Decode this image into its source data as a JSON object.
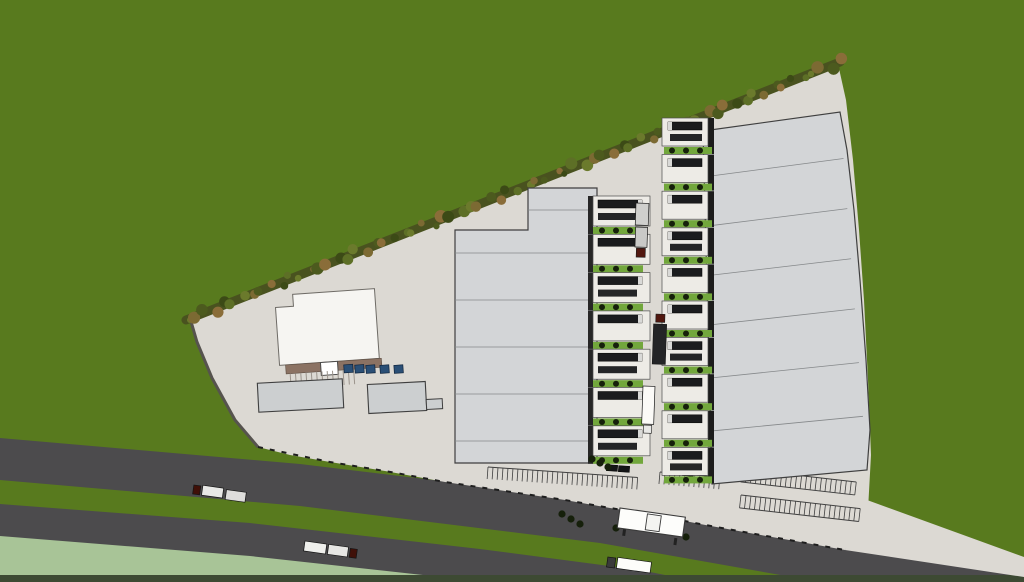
{
  "scene": {
    "label": "aerial-3d-render-logistics-park-site-plan",
    "canvas": {
      "width": 1024,
      "height": 582
    },
    "colors": {
      "grass": "#587a1e",
      "infield": "#a8c497",
      "road": "#4c4b4d",
      "pavement": "#dcd9d3",
      "apron": "#edebe6",
      "roof": "#d3d5d7",
      "roof_seam": "#85888a",
      "outline": "#3f3f3f",
      "office_white": "#f6f5f2",
      "canopy_brown": "#8b7263",
      "small_building": "#cccfd0",
      "dock_green": "#72a73c",
      "bush": "#16200b",
      "trailer_dark": "#1b1c1e",
      "trailer_cap": "#d9d9d7",
      "cab_red": "#51170f",
      "fence": "#1e1e1e",
      "wall_dark": "#56534e",
      "wall_light": "#e4e1da",
      "bottom_strip": "#3d4a33",
      "car_blue": "#2a4f76",
      "car_dark": "#141517",
      "tree_band": "#49521f",
      "tree_palette": [
        "#6b7a2c",
        "#7c6a33",
        "#4c5a1e",
        "#8a6d39",
        "#3c4a16",
        "#5d6f26"
      ]
    },
    "landscape": {
      "infield_polygon": [
        [
          0,
          534
        ],
        [
          250,
          553
        ],
        [
          430,
          570
        ],
        [
          555,
          582
        ],
        [
          0,
          582
        ]
      ],
      "road_upper_polygon": [
        [
          0,
          438
        ],
        [
          300,
          464
        ],
        [
          600,
          500
        ],
        [
          870,
          549
        ],
        [
          1024,
          575
        ],
        [
          1024,
          582
        ],
        [
          820,
          582
        ],
        [
          600,
          543
        ],
        [
          300,
          506
        ],
        [
          0,
          480
        ]
      ],
      "road_lower_polygon": [
        [
          0,
          504
        ],
        [
          250,
          523
        ],
        [
          480,
          549
        ],
        [
          640,
          570
        ],
        [
          700,
          582
        ],
        [
          485,
          582
        ],
        [
          450,
          578
        ],
        [
          250,
          556
        ],
        [
          0,
          536
        ]
      ],
      "bottom_strip_rect": [
        0,
        575,
        1024,
        7
      ]
    },
    "site": {
      "pavement_polygon": [
        [
          190,
          318
        ],
        [
          838,
          64
        ],
        [
          846,
          100
        ],
        [
          853,
          160
        ],
        [
          859,
          230
        ],
        [
          864,
          300
        ],
        [
          868,
          380
        ],
        [
          871,
          455
        ],
        [
          868,
          510
        ],
        [
          845,
          550
        ],
        [
          795,
          541
        ],
        [
          755,
          534
        ],
        [
          700,
          524
        ],
        [
          655,
          515
        ],
        [
          610,
          508
        ],
        [
          565,
          500
        ],
        [
          505,
          491
        ],
        [
          445,
          482
        ],
        [
          385,
          471
        ],
        [
          330,
          462
        ],
        [
          290,
          455
        ],
        [
          258,
          447
        ],
        [
          235,
          420
        ],
        [
          212,
          378
        ],
        [
          197,
          342
        ]
      ],
      "access_apron_polygon": [
        [
          867,
          500
        ],
        [
          1024,
          557
        ],
        [
          1024,
          577
        ],
        [
          845,
          550
        ]
      ],
      "top_wall_line": [
        190,
        318,
        838,
        64
      ],
      "left_wall_path": "M190,318 L197,342 L212,378 L235,420 L258,447",
      "fence_path": "M258,447 L330,462 L385,471 L445,482 L505,491 L565,500 L610,508 L655,515 L700,524 L755,534 L795,541 L845,550",
      "tree_line": {
        "from": [
          186,
          320
        ],
        "to": [
          840,
          62
        ],
        "count": 70
      }
    },
    "buildings": {
      "warehouse_left": {
        "polygon": [
          [
            528,
            188
          ],
          [
            597,
            188
          ],
          [
            597,
            463
          ],
          [
            455,
            463
          ],
          [
            455,
            230
          ],
          [
            528,
            230
          ]
        ],
        "seams": [
          {
            "x1": 528,
            "x2": 597,
            "y": 210
          },
          {
            "x1": 455,
            "x2": 597,
            "y": 253
          },
          {
            "x1": 455,
            "x2": 597,
            "y": 300
          },
          {
            "x1": 455,
            "x2": 597,
            "y": 347
          },
          {
            "x1": 455,
            "x2": 597,
            "y": 394
          },
          {
            "x1": 455,
            "x2": 597,
            "y": 441
          }
        ]
      },
      "warehouse_right": {
        "polygon": [
          [
            703,
            131
          ],
          [
            840,
            112
          ],
          [
            847,
            150
          ],
          [
            854,
            210
          ],
          [
            860,
            280
          ],
          [
            866,
            360
          ],
          [
            870,
            430
          ],
          [
            867,
            470
          ],
          [
            712,
            484
          ]
        ],
        "left_edge": {
          "top": [
            703,
            131
          ],
          "bottom": [
            712,
            484
          ]
        },
        "right_edge": {
          "top": [
            840,
            112
          ],
          "bottom": [
            867,
            470
          ]
        },
        "seam_ts": [
          0.13,
          0.27,
          0.41,
          0.55,
          0.7,
          0.85
        ]
      },
      "office": {
        "polygon": [
          [
            277,
            304
          ],
          [
            295,
            304
          ],
          [
            295,
            292
          ],
          [
            377,
            292
          ],
          [
            377,
            362
          ],
          [
            277,
            362
          ]
        ],
        "rotate": [
          -4,
          327,
          327
        ],
        "canopy": [
          283,
          362,
          96,
          9
        ],
        "canopy_box": [
          318,
          362,
          17,
          13
        ],
        "comb": {
          "x": 287,
          "y": 371,
          "count": 13,
          "step": 5.3,
          "len": 15
        },
        "cars_blue": [
          [
            341,
            366
          ],
          [
            352,
            367
          ],
          [
            363,
            368
          ],
          [
            377,
            369
          ],
          [
            391,
            370
          ]
        ]
      },
      "storage_a": {
        "rect": [
          258,
          381,
          85,
          29
        ],
        "rotate": [
          -3,
          300,
          395
        ]
      },
      "storage_b": {
        "rect": [
          368,
          383,
          58,
          29
        ],
        "tab": [
          426,
          401,
          16,
          10
        ],
        "rotate": [
          -3,
          397,
          397
        ]
      },
      "gatehouse": {
        "x": 620,
        "y": 508,
        "angle": 8,
        "body": [
          0,
          0,
          66,
          20
        ],
        "inner": [
          28,
          2,
          14,
          16
        ],
        "posts": [
          [
            6,
            20,
            3,
            7
          ],
          [
            58,
            22,
            3,
            7
          ]
        ]
      }
    },
    "docks": {
      "left_row": {
        "x": 593,
        "y_start": 196,
        "pitch": 38.3,
        "count": 7,
        "width": 57,
        "apron_h": 30,
        "facing": "east"
      },
      "right_row": {
        "x": 662,
        "y_start": 118,
        "pitch": 36.6,
        "count": 10,
        "width": 46,
        "apron_h": 28,
        "facing": "west"
      }
    },
    "parking": {
      "rows": [
        {
          "x": 488,
          "y": 467,
          "angle": 4,
          "count": 30,
          "stall": 5,
          "depth": 12,
          "double": false
        },
        {
          "x": 660,
          "y": 472,
          "angle": 5,
          "count": 12,
          "stall": 5,
          "depth": 12,
          "double": false
        },
        {
          "x": 742,
          "y": 469,
          "angle": 6.5,
          "count": 23,
          "stall": 5,
          "depth": 13,
          "double": true
        },
        {
          "x": 741,
          "y": 495,
          "angle": 6.5,
          "count": 24,
          "stall": 5,
          "depth": 13,
          "double": true
        }
      ],
      "cars": [
        [
          612,
          468,
          4
        ],
        [
          624,
          469,
          4
        ],
        [
          688,
          473,
          5
        ],
        [
          739,
          473,
          80
        ]
      ]
    },
    "bushes": [
      [
        562,
        514
      ],
      [
        571,
        519
      ],
      [
        580,
        524
      ],
      [
        616,
        528
      ],
      [
        686,
        537
      ],
      [
        592,
        459
      ],
      [
        600,
        463
      ],
      [
        608,
        467
      ]
    ],
    "vehicles": {
      "yard_trucks": [
        {
          "x": 636,
          "y": 203,
          "angle": 2,
          "boxes": [
            [
              0,
              0,
              13,
              22,
              "#cfcfcd"
            ],
            [
              0.5,
              24,
              12,
              20,
              "#c9c9c7"
            ]
          ],
          "cab": [
            2,
            45,
            9,
            9,
            "#51170f"
          ]
        },
        {
          "x": 654,
          "y": 314,
          "angle": 2,
          "boxes": [
            [
              0,
              10,
              13,
              40,
              "#232426"
            ]
          ],
          "cab": [
            2,
            0,
            9,
            8,
            "#51170f"
          ]
        },
        {
          "x": 643,
          "y": 386,
          "angle": 2,
          "boxes": [
            [
              0,
              0,
              12,
              38,
              "#fbfaf7"
            ]
          ],
          "cab": [
            2,
            39,
            8,
            8,
            "#e8e8e6"
          ]
        }
      ],
      "road_trucks": [
        {
          "x": 194,
          "y": 484,
          "angle": 8,
          "parts": [
            [
              "cab",
              0,
              1,
              7,
              9,
              "#401008"
            ],
            [
              "box",
              9,
              0,
              21,
              10,
              "#e8e8e6"
            ],
            [
              "box",
              33,
              1,
              20,
              10,
              "#dedddb"
            ]
          ]
        },
        {
          "x": 305,
          "y": 541,
          "angle": 8,
          "parts": [
            [
              "box",
              0,
              0,
              22,
              10,
              "#efefec"
            ],
            [
              "box",
              24,
              0,
              20,
              10,
              "#e7e7e4"
            ],
            [
              "cab",
              46,
              1,
              7,
              9,
              "#401008"
            ]
          ]
        },
        {
          "x": 608,
          "y": 556,
          "angle": 8,
          "parts": [
            [
              "cab",
              0,
              1,
              8,
              10,
              "#3a3a3a"
            ],
            [
              "box",
              10,
              0,
              34,
              11,
              "#fdfdfa"
            ]
          ]
        }
      ]
    }
  }
}
